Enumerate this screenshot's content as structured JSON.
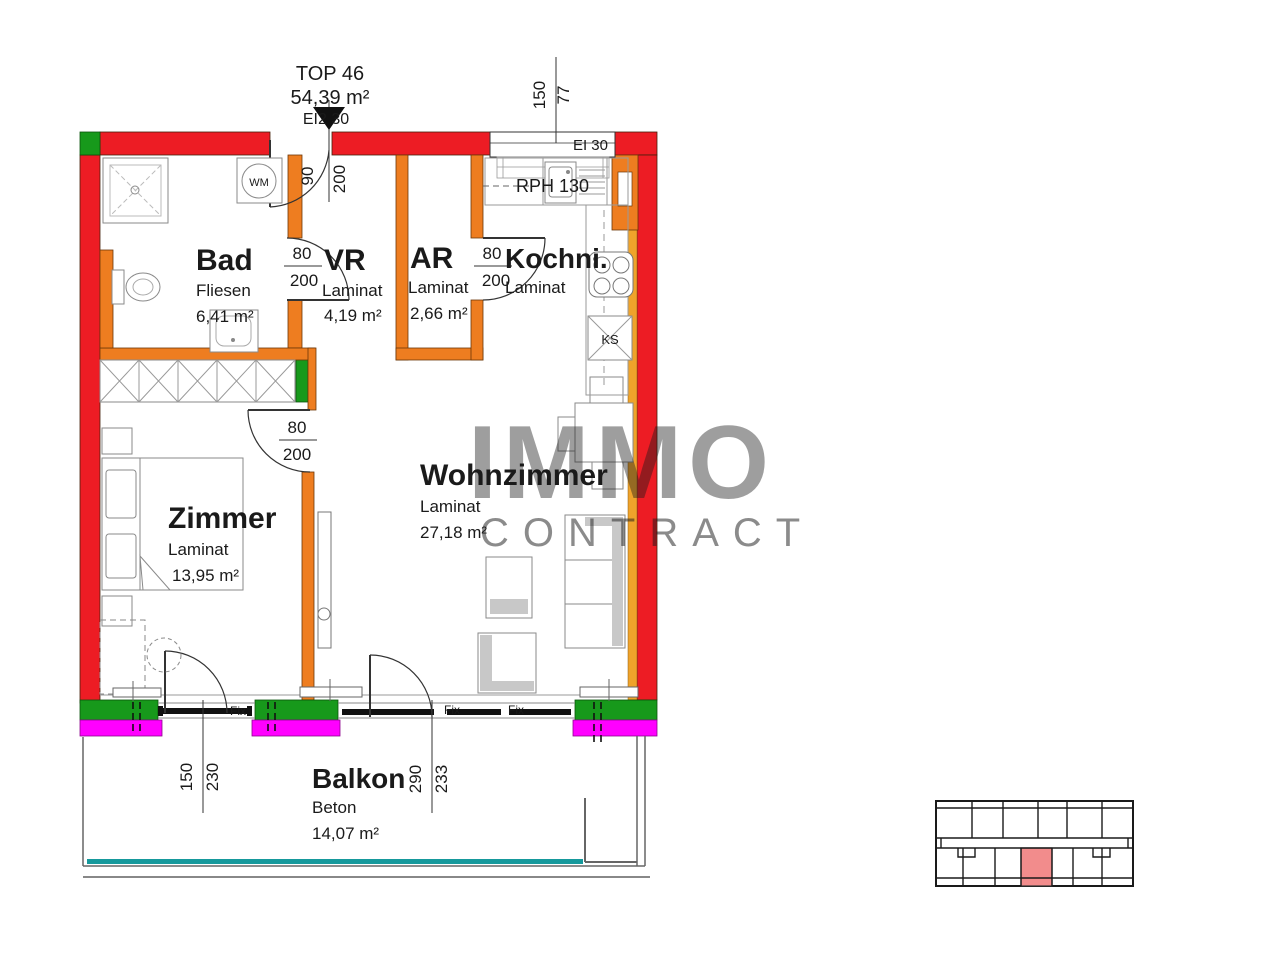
{
  "title": {
    "unit": "TOP 46",
    "area": "54,39 m²",
    "rating": "EI2 30"
  },
  "rooms": {
    "bad": {
      "name": "Bad",
      "floor": "Fliesen",
      "area": "6,41 m²"
    },
    "vr": {
      "name": "VR",
      "floor": "Laminat",
      "area": "4,19 m²"
    },
    "ar": {
      "name": "AR",
      "floor": "Laminat",
      "area": "2,66 m²"
    },
    "kochnische": {
      "name": "Kochni.",
      "floor": "Laminat"
    },
    "zimmer": {
      "name": "Zimmer",
      "floor": "Laminat",
      "area": "13,95 m²"
    },
    "wohnzimmer": {
      "name": "Wohnzimmer",
      "floor": "Laminat",
      "area": "27,18 m²"
    },
    "balkon": {
      "name": "Balkon",
      "floor": "Beton",
      "area": "14,07 m²"
    }
  },
  "doors": {
    "entry": {
      "width": "90",
      "height": "200"
    },
    "bad": {
      "width": "80",
      "height": "200"
    },
    "ar": {
      "width": "80",
      "height": "200"
    },
    "zimmer": {
      "width": "80",
      "height": "200"
    }
  },
  "windows": {
    "kitchen": {
      "width": "150",
      "parapet": "77",
      "rating": "EI 30"
    },
    "zimmer": {
      "width": "150",
      "parapet": "230"
    },
    "wohnzimmer": {
      "width": "290",
      "parapet": "233"
    },
    "fixed_label": "Fix"
  },
  "fixtures": {
    "washing_machine": "WM",
    "fridge": "KS",
    "kitchen_note": "RPH 130"
  },
  "watermark": {
    "line1": "IMMO",
    "line2": "CONTRACT"
  },
  "colors": {
    "wall_red": "#ed1c24",
    "wall_orange": "#ee7d20",
    "wall_amber": "#efa32b",
    "accent_green": "#17991b",
    "accent_magenta": "#ff00ff",
    "balcony_teal": "#16999c",
    "minimap_highlight": "#f28c8c"
  }
}
